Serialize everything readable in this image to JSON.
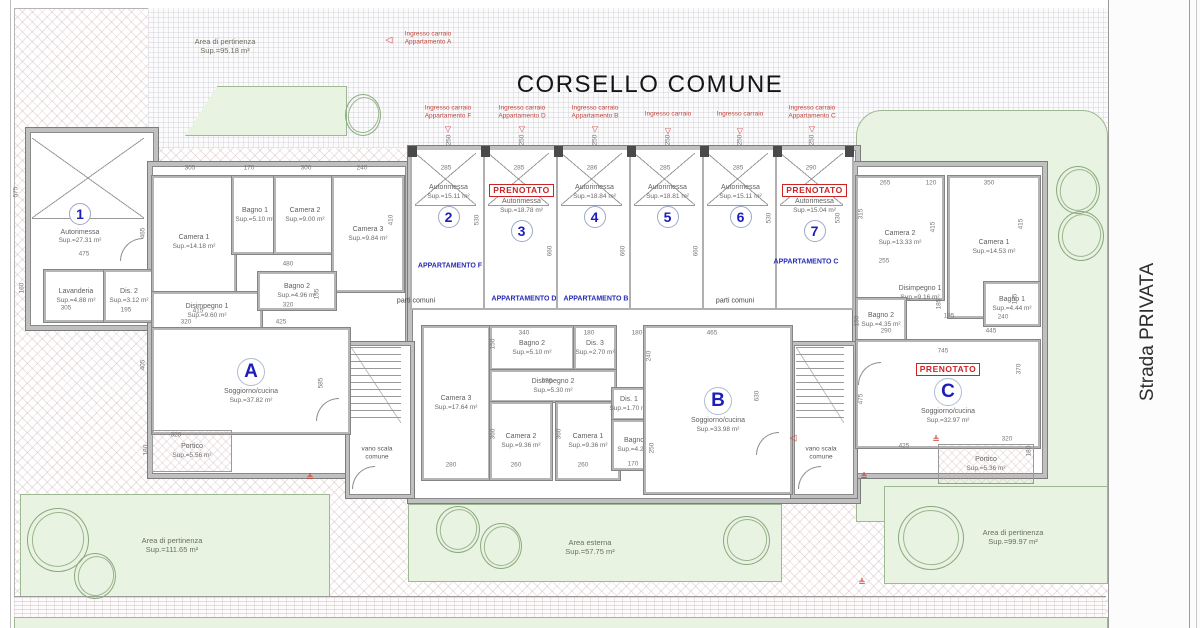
{
  "header": {
    "title": "CORSELLO COMUNE"
  },
  "road_label": "Strada PRIVATA",
  "reserved_label": "PRENOTATO",
  "stairs": {
    "l1": "vano scala",
    "l2": "comune"
  },
  "areas": {
    "top_left": {
      "name": "Area di pertinenza",
      "sup": "Sup.=95.18 m²"
    },
    "bottom_left": {
      "name": "Area di pertinenza",
      "sup": "Sup.=111.65 m²"
    },
    "outdoor": {
      "name": "Area esterna",
      "sup": "Sup.=57.75 m²"
    },
    "bottom_right": {
      "name": "Area di pertinenza",
      "sup": "Sup.=99.97 m²"
    }
  },
  "entrances": [
    {
      "l1": "Ingresso carraio",
      "l2": "Appartamento A",
      "x": 428,
      "y": 38,
      "fan": false
    },
    {
      "l1": "Ingresso carraio",
      "l2": "Appartamento F",
      "x": 448,
      "y": 112,
      "fan": true
    },
    {
      "l1": "Ingresso carraio",
      "l2": "Appartamento D",
      "x": 522,
      "y": 112,
      "fan": true
    },
    {
      "l1": "Ingresso carraio",
      "l2": "Appartamento B",
      "x": 595,
      "y": 112,
      "fan": true
    },
    {
      "l1": "Ingresso carraio",
      "l2": "",
      "x": 668,
      "y": 114,
      "fan": true
    },
    {
      "l1": "Ingresso carraio",
      "l2": "",
      "x": 740,
      "y": 114,
      "fan": true
    },
    {
      "l1": "Ingresso carraio",
      "l2": "Appartamento C",
      "x": 812,
      "y": 112,
      "fan": true
    }
  ],
  "garages": [
    {
      "num": "1",
      "label": "Autorimessa",
      "sup": "Sup.=27.31 m²",
      "reserved": false
    },
    {
      "num": "2",
      "label": "Autorimessa",
      "sup": "Sup.=15.11 m²",
      "x": 410,
      "w": 73,
      "reserved": false
    },
    {
      "num": "3",
      "label": "Autorimessa",
      "sup": "Sup.=18.78 m²",
      "x": 483,
      "w": 73,
      "reserved": true
    },
    {
      "num": "4",
      "label": "Autorimessa",
      "sup": "Sup.=18.84 m²",
      "x": 556,
      "w": 73,
      "reserved": false
    },
    {
      "num": "5",
      "label": "Autorimessa",
      "sup": "Sup.=18.81 m²",
      "x": 629,
      "w": 73,
      "reserved": false
    },
    {
      "num": "6",
      "label": "Autorimessa",
      "sup": "Sup.=15.11 m²",
      "x": 702,
      "w": 73,
      "reserved": false
    },
    {
      "num": "7",
      "label": "Autorimessa",
      "sup": "Sup.=15.04 m²",
      "x": 775,
      "w": 75,
      "reserved": true
    }
  ],
  "wing_labels": [
    {
      "t": "APPARTAMENTO F",
      "x": 450,
      "y": 266
    },
    {
      "t": "APPARTAMENTO D",
      "x": 524,
      "y": 299
    },
    {
      "t": "APPARTAMENTO B",
      "x": 596,
      "y": 299
    },
    {
      "t": "APPARTAMENTO C",
      "x": 806,
      "y": 262
    }
  ],
  "common_labels": [
    {
      "t": "parti comuni",
      "x": 416,
      "y": 301
    },
    {
      "t": "parti comuni",
      "x": 735,
      "y": 301
    }
  ],
  "rooms": [
    {
      "id": "lavanderia",
      "name": "Lavanderia",
      "sup": "Sup.=4.88 m²",
      "x": 44,
      "y": 270,
      "w": 60,
      "h": 48
    },
    {
      "id": "dis2-sx",
      "name": "Dis. 2",
      "sup": "Sup.=3.12 m²",
      "x": 104,
      "y": 270,
      "w": 46,
      "h": 48
    },
    {
      "id": "a-camera1",
      "name": "Camera 1",
      "sup": "Sup.=14.18 m²",
      "x": 152,
      "y": 176,
      "w": 80,
      "h": 128
    },
    {
      "id": "a-bagno1",
      "name": "Bagno 1",
      "sup": "Sup.=5.10 m²",
      "x": 232,
      "y": 176,
      "w": 42,
      "h": 74
    },
    {
      "id": "a-camera2",
      "name": "Camera 2",
      "sup": "Sup.=9.00 m²",
      "x": 274,
      "y": 176,
      "w": 58,
      "h": 74
    },
    {
      "id": "a-camera3",
      "name": "Camera 3",
      "sup": "Sup.=9.84 m²",
      "x": 332,
      "y": 176,
      "w": 68,
      "h": 112
    },
    {
      "id": "a-disimpegno1",
      "name": "Disimpegno 1",
      "sup": "Sup.=9.60 m²",
      "x": 152,
      "y": 292,
      "w": 106,
      "h": 34
    },
    {
      "id": "a-bagno2",
      "name": "Bagno 2",
      "sup": "Sup.=4.96 m²",
      "x": 258,
      "y": 272,
      "w": 74,
      "h": 34
    },
    {
      "id": "a-soggiorno",
      "name": "Soggiorno/cucina",
      "sup": "Sup.=37.82 m²",
      "x": 152,
      "y": 328,
      "w": 194,
      "h": 102,
      "letter": "A"
    },
    {
      "id": "a-portico",
      "name": "Portico",
      "sup": "Sup.=5.56 m²",
      "x": 152,
      "y": 430,
      "w": 78,
      "h": 40,
      "open": true
    },
    {
      "id": "b-camera3",
      "name": "Camera 3",
      "sup": "Sup.=17.64 m²",
      "x": 422,
      "y": 326,
      "w": 64,
      "h": 150
    },
    {
      "id": "b-bagno2",
      "name": "Bagno 2",
      "sup": "Sup.=5.10 m²",
      "x": 490,
      "y": 326,
      "w": 80,
      "h": 40
    },
    {
      "id": "b-dis3",
      "name": "Dis. 3",
      "sup": "Sup.=2.70 m²",
      "x": 574,
      "y": 326,
      "w": 38,
      "h": 40
    },
    {
      "id": "b-disimpegno2",
      "name": "Disimpegno 2",
      "sup": "Sup.=5.30 m²",
      "x": 490,
      "y": 370,
      "w": 122,
      "h": 28
    },
    {
      "id": "b-camera2",
      "name": "Camera 2",
      "sup": "Sup.=9.36 m²",
      "x": 490,
      "y": 402,
      "w": 58,
      "h": 74
    },
    {
      "id": "b-camera1",
      "name": "Camera 1",
      "sup": "Sup.=9.36 m²",
      "x": 556,
      "y": 402,
      "w": 60,
      "h": 74
    },
    {
      "id": "b-dis1",
      "name": "Dis. 1",
      "sup": "Sup.=1.70 m²",
      "x": 612,
      "y": 388,
      "w": 30,
      "h": 28
    },
    {
      "id": "b-bagno1",
      "name": "Bagno 1",
      "sup": "Sup.=4.25 m²",
      "x": 612,
      "y": 420,
      "w": 46,
      "h": 46
    },
    {
      "id": "b-soggiorno",
      "name": "Soggiorno/cucina",
      "sup": "Sup.=33.98 m²",
      "x": 644,
      "y": 326,
      "w": 144,
      "h": 164,
      "letter": "B"
    },
    {
      "id": "c-camera2",
      "name": "Camera 2",
      "sup": "Sup.=13.33 m²",
      "x": 856,
      "y": 176,
      "w": 84,
      "h": 120
    },
    {
      "id": "c-camera1",
      "name": "Camera 1",
      "sup": "Sup.=14.53 m²",
      "x": 948,
      "y": 176,
      "w": 88,
      "h": 138
    },
    {
      "id": "c-disimpegno1",
      "name": "Disimpegno 1",
      "sup": "Sup.=9.16 m²",
      "x": 875,
      "y": 280,
      "w": 90,
      "h": 26,
      "nobox": true
    },
    {
      "id": "c-bagno2",
      "name": "Bagno 2",
      "sup": "Sup.=4.35 m²",
      "x": 856,
      "y": 298,
      "w": 46,
      "h": 40
    },
    {
      "id": "c-bagno1",
      "name": "Bagno 1",
      "sup": "Sup.=4.44 m²",
      "x": 984,
      "y": 282,
      "w": 52,
      "h": 40
    },
    {
      "id": "c-soggiorno",
      "name": "Soggiorno/cucina",
      "sup": "Sup.=32.97 m²",
      "x": 856,
      "y": 340,
      "w": 180,
      "h": 104,
      "letter": "C",
      "reserved": true
    },
    {
      "id": "c-portico",
      "name": "Portico",
      "sup": "Sup.=5.36 m²",
      "x": 938,
      "y": 444,
      "w": 94,
      "h": 38,
      "open": true
    }
  ],
  "dims": [
    [
      "575",
      16,
      192,
      1
    ],
    [
      "475",
      84,
      254,
      0
    ],
    [
      "160",
      22,
      288,
      1
    ],
    [
      "305",
      66,
      308,
      0
    ],
    [
      "195",
      126,
      310,
      0
    ],
    [
      "305",
      190,
      168,
      0
    ],
    [
      "170",
      249,
      168,
      0
    ],
    [
      "300",
      306,
      168,
      0
    ],
    [
      "240",
      362,
      168,
      0
    ],
    [
      "465",
      143,
      233,
      1
    ],
    [
      "410",
      391,
      220,
      1
    ],
    [
      "480",
      288,
      264,
      0
    ],
    [
      "320",
      186,
      322,
      0
    ],
    [
      "425",
      281,
      322,
      0
    ],
    [
      "405",
      143,
      365,
      1
    ],
    [
      "585",
      321,
      383,
      1
    ],
    [
      "415",
      198,
      311,
      0
    ],
    [
      "320",
      288,
      305,
      0
    ],
    [
      "155",
      317,
      294,
      1
    ],
    [
      "320",
      176,
      435,
      0
    ],
    [
      "180",
      146,
      450,
      1
    ],
    [
      "285",
      446,
      168,
      0
    ],
    [
      "285",
      519,
      168,
      0
    ],
    [
      "286",
      592,
      168,
      0
    ],
    [
      "285",
      665,
      168,
      0
    ],
    [
      "285",
      738,
      168,
      0
    ],
    [
      "290",
      811,
      168,
      0
    ],
    [
      "530",
      477,
      220,
      1
    ],
    [
      "660",
      550,
      251,
      1
    ],
    [
      "660",
      623,
      251,
      1
    ],
    [
      "660",
      696,
      251,
      1
    ],
    [
      "530",
      769,
      218,
      1
    ],
    [
      "530",
      838,
      218,
      1
    ],
    [
      "250",
      449,
      140,
      1
    ],
    [
      "250",
      522,
      140,
      1
    ],
    [
      "250",
      595,
      140,
      1
    ],
    [
      "250",
      668,
      140,
      1
    ],
    [
      "250",
      740,
      140,
      1
    ],
    [
      "250",
      812,
      140,
      1
    ],
    [
      "340",
      524,
      333,
      0
    ],
    [
      "180",
      589,
      333,
      0
    ],
    [
      "150",
      493,
      344,
      1
    ],
    [
      "530",
      547,
      381,
      0
    ],
    [
      "280",
      451,
      465,
      0
    ],
    [
      "260",
      516,
      465,
      0
    ],
    [
      "260",
      583,
      465,
      0
    ],
    [
      "360",
      493,
      434,
      1
    ],
    [
      "360",
      559,
      434,
      1
    ],
    [
      "170",
      633,
      464,
      0
    ],
    [
      "250",
      652,
      448,
      1
    ],
    [
      "465",
      712,
      333,
      0
    ],
    [
      "180",
      637,
      333,
      0
    ],
    [
      "240",
      649,
      356,
      1
    ],
    [
      "630",
      757,
      396,
      1
    ],
    [
      "265",
      885,
      183,
      0
    ],
    [
      "120",
      931,
      183,
      0
    ],
    [
      "350",
      989,
      183,
      0
    ],
    [
      "315",
      861,
      214,
      1
    ],
    [
      "415",
      933,
      227,
      1
    ],
    [
      "415",
      1021,
      224,
      1
    ],
    [
      "255",
      884,
      261,
      0
    ],
    [
      "195",
      949,
      316,
      0
    ],
    [
      "185",
      939,
      304,
      1
    ],
    [
      "240",
      1003,
      317,
      0
    ],
    [
      "185",
      1015,
      299,
      1
    ],
    [
      "290",
      886,
      331,
      0
    ],
    [
      "150",
      857,
      321,
      1
    ],
    [
      "445",
      991,
      331,
      0
    ],
    [
      "745",
      943,
      351,
      0
    ],
    [
      "370",
      1019,
      369,
      1
    ],
    [
      "475",
      861,
      399,
      1
    ],
    [
      "425",
      904,
      446,
      0
    ],
    [
      "320",
      1007,
      439,
      0
    ],
    [
      "180",
      1029,
      451,
      1
    ]
  ],
  "trees": [
    [
      345,
      94,
      34,
      40
    ],
    [
      1056,
      166,
      42,
      46
    ],
    [
      1058,
      211,
      44,
      48
    ],
    [
      27,
      508,
      60,
      62
    ],
    [
      74,
      553,
      40,
      44
    ],
    [
      436,
      506,
      42,
      45
    ],
    [
      480,
      523,
      40,
      44
    ],
    [
      723,
      516,
      45,
      47
    ],
    [
      898,
      506,
      64,
      62
    ]
  ],
  "marks": [
    {
      "t": "◁",
      "x": 389,
      "y": 40
    },
    {
      "t": "◁",
      "x": 793,
      "y": 438
    },
    {
      "t": "≜",
      "x": 310,
      "y": 478
    },
    {
      "t": "≜",
      "x": 864,
      "y": 477
    },
    {
      "t": "≜",
      "x": 936,
      "y": 440
    },
    {
      "t": "≜",
      "x": 862,
      "y": 583
    }
  ]
}
